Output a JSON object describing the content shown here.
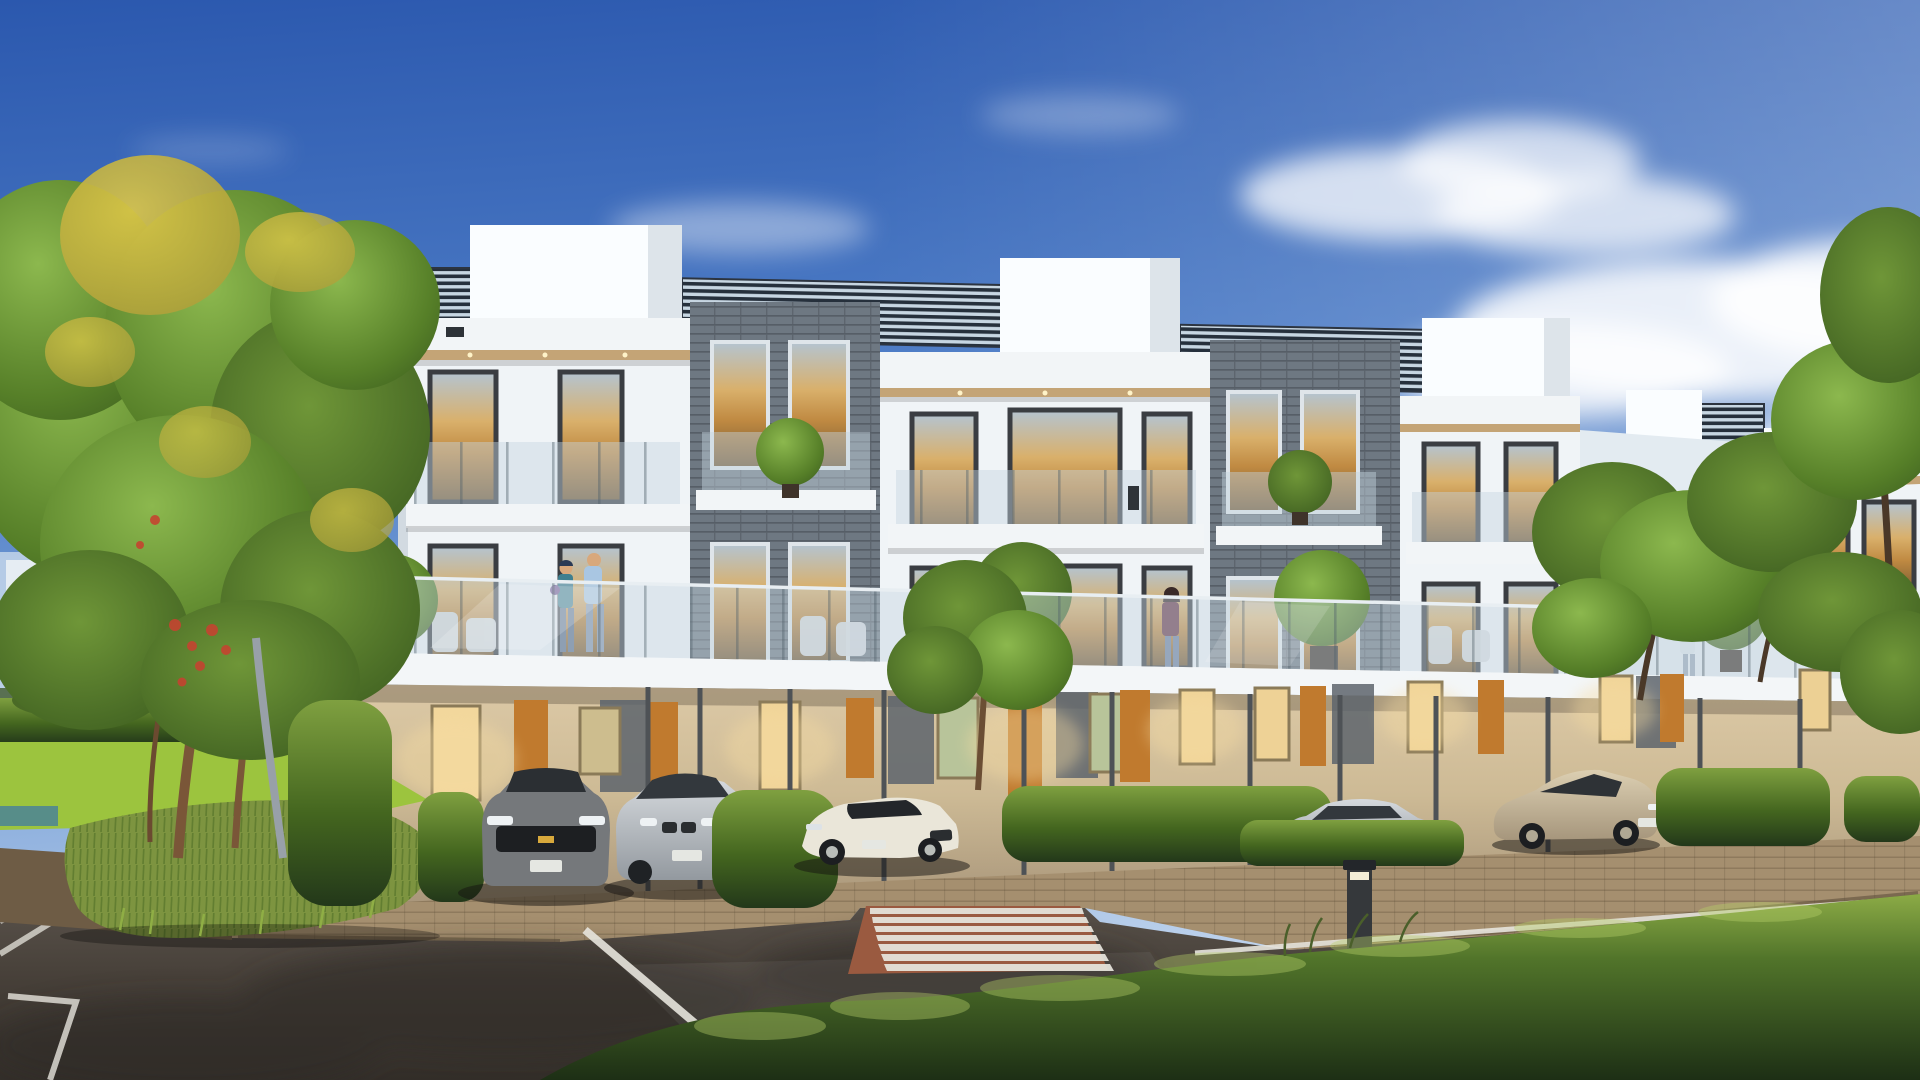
{
  "scene": {
    "title": "Dusk architectural rendering of a modern three-story townhouse row with carports, parked cars, balconies with residents, trees and a street with crosswalk",
    "time_of_day": "dusk",
    "elements": [
      "blue sky with soft clouds",
      "row of modern townhouses with alternating white and gray-brick bays",
      "rooftop louver privacy screens",
      "white roof cubes",
      "wood-lined canopies with downlights",
      "full-width glass-railing balcony with potted trees and patio chairs",
      "three groups of residents on the balconies",
      "ground-floor carports with warm lit windows and timber doors",
      "five parked cars",
      "trimmed hedges between parking bays",
      "large flowering tree and lawn on the left",
      "curved street lamp",
      "grass island with tall grass",
      "paved forecourt",
      "asphalt road with white lane markings and brick-based crosswalk",
      "light bollard",
      "dense foreground hedge"
    ]
  },
  "objects": {
    "cars": [
      {
        "name": "dark gray muscle car",
        "view": "front",
        "location": "left carport"
      },
      {
        "name": "silver sedan",
        "view": "front three-quarter",
        "location": "left carport"
      },
      {
        "name": "white sports car",
        "view": "three-quarter",
        "location": "center carport"
      },
      {
        "name": "silver car behind hedge",
        "view": "side",
        "location": "right carport"
      },
      {
        "name": "champagne coupe",
        "view": "side",
        "location": "right carport"
      }
    ],
    "people": [
      {
        "name": "couple talking",
        "location": "left section of long balcony"
      },
      {
        "name": "woman in dark vest",
        "location": "center balcony"
      },
      {
        "name": "person in light shirt",
        "location": "right terrace"
      }
    ]
  },
  "colors": {
    "sky_top": "#2b58ae",
    "sky_mid": "#5d86cc",
    "sky_low": "#b8cfec",
    "cloud_white": "#ffffff",
    "building_white": "#f0f4f7",
    "building_shadow": "#d2dae1",
    "roof_white": "#fafdff",
    "louver_dark": "#26303c",
    "brick_gray": "#6e7882",
    "brick_line": "#565e67",
    "soffit_wood": "#c4a476",
    "window_frame": "#3a3d42",
    "glass_warm": "#d9b06b",
    "wall_beige": "#d3c2a0",
    "door_wood": "#c07a2e",
    "hedge_dark": "#23381a",
    "hedge_light": "#5d8a31",
    "hedge_bright": "#9ab84a",
    "lawn_green": "#9cc43e",
    "grass_island": "#7d9440",
    "tree_green": "#567f28",
    "tree_yellow": "#d9c93e",
    "tree_red": "#c44430",
    "tree_trunk": "#7a5638",
    "paver_tan": "#a58f6f",
    "dirt_brown": "#6e5c45",
    "road_gray": "#474039",
    "road_marking": "#e7e5dd",
    "crosswalk_red": "#9a5a40",
    "car_gray": "#75787b",
    "car_silver": "#c6cacf",
    "car_white": "#eae6d9",
    "car_champagne": "#c9b999",
    "lamp_metal": "#98a0a8",
    "bollard_dark": "#35383b",
    "skin": "#d8a87c",
    "shirt_blue": "#a9c6e2",
    "shirt_teal": "#3f7f8f",
    "shirt_maroon": "#6a3a4a",
    "jeans": "#6f82a0"
  }
}
